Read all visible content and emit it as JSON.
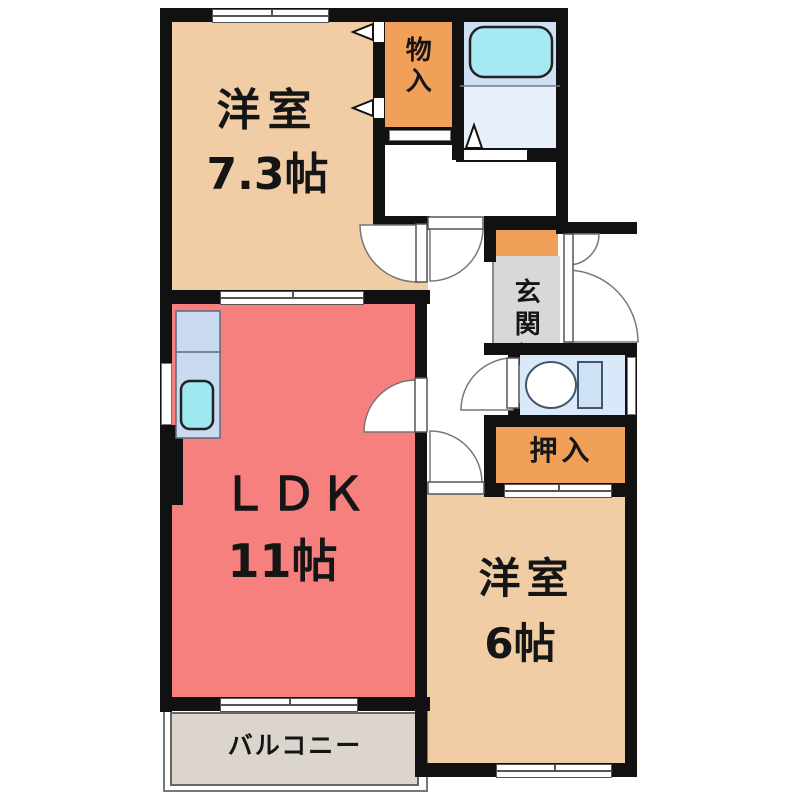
{
  "plan_title": "2LDK floor plan",
  "rooms": {
    "western_7_3": {
      "name": "洋室",
      "size": "7.3帖"
    },
    "storage": {
      "name": "物入"
    },
    "entrance": {
      "name": "玄関"
    },
    "closet": {
      "name": "押入"
    },
    "ldk": {
      "name": "ＬＤＫ",
      "size": "11帖"
    },
    "western_6": {
      "name": "洋室",
      "size": "6帖"
    },
    "balcony": {
      "name": "バルコニー"
    }
  },
  "colors": {
    "wall": "#111111",
    "room_beige": "#f1cda5",
    "closet_orange": "#f0a058",
    "ldk_pink": "#f5807e",
    "entrance_gray": "#d8d8d8",
    "entrance_step_orange": "#f0a058",
    "bath_blue_upper": "#cfe0f3",
    "bath_blue_lower": "#e7effb",
    "tub_cyan": "#a5e9f2",
    "toilet_blue": "#d9e9f9",
    "kitchen_counter_blue": "#c9daf1",
    "sink_cyan": "#9de9ef",
    "balcony_gray": "#dbd5cd"
  }
}
